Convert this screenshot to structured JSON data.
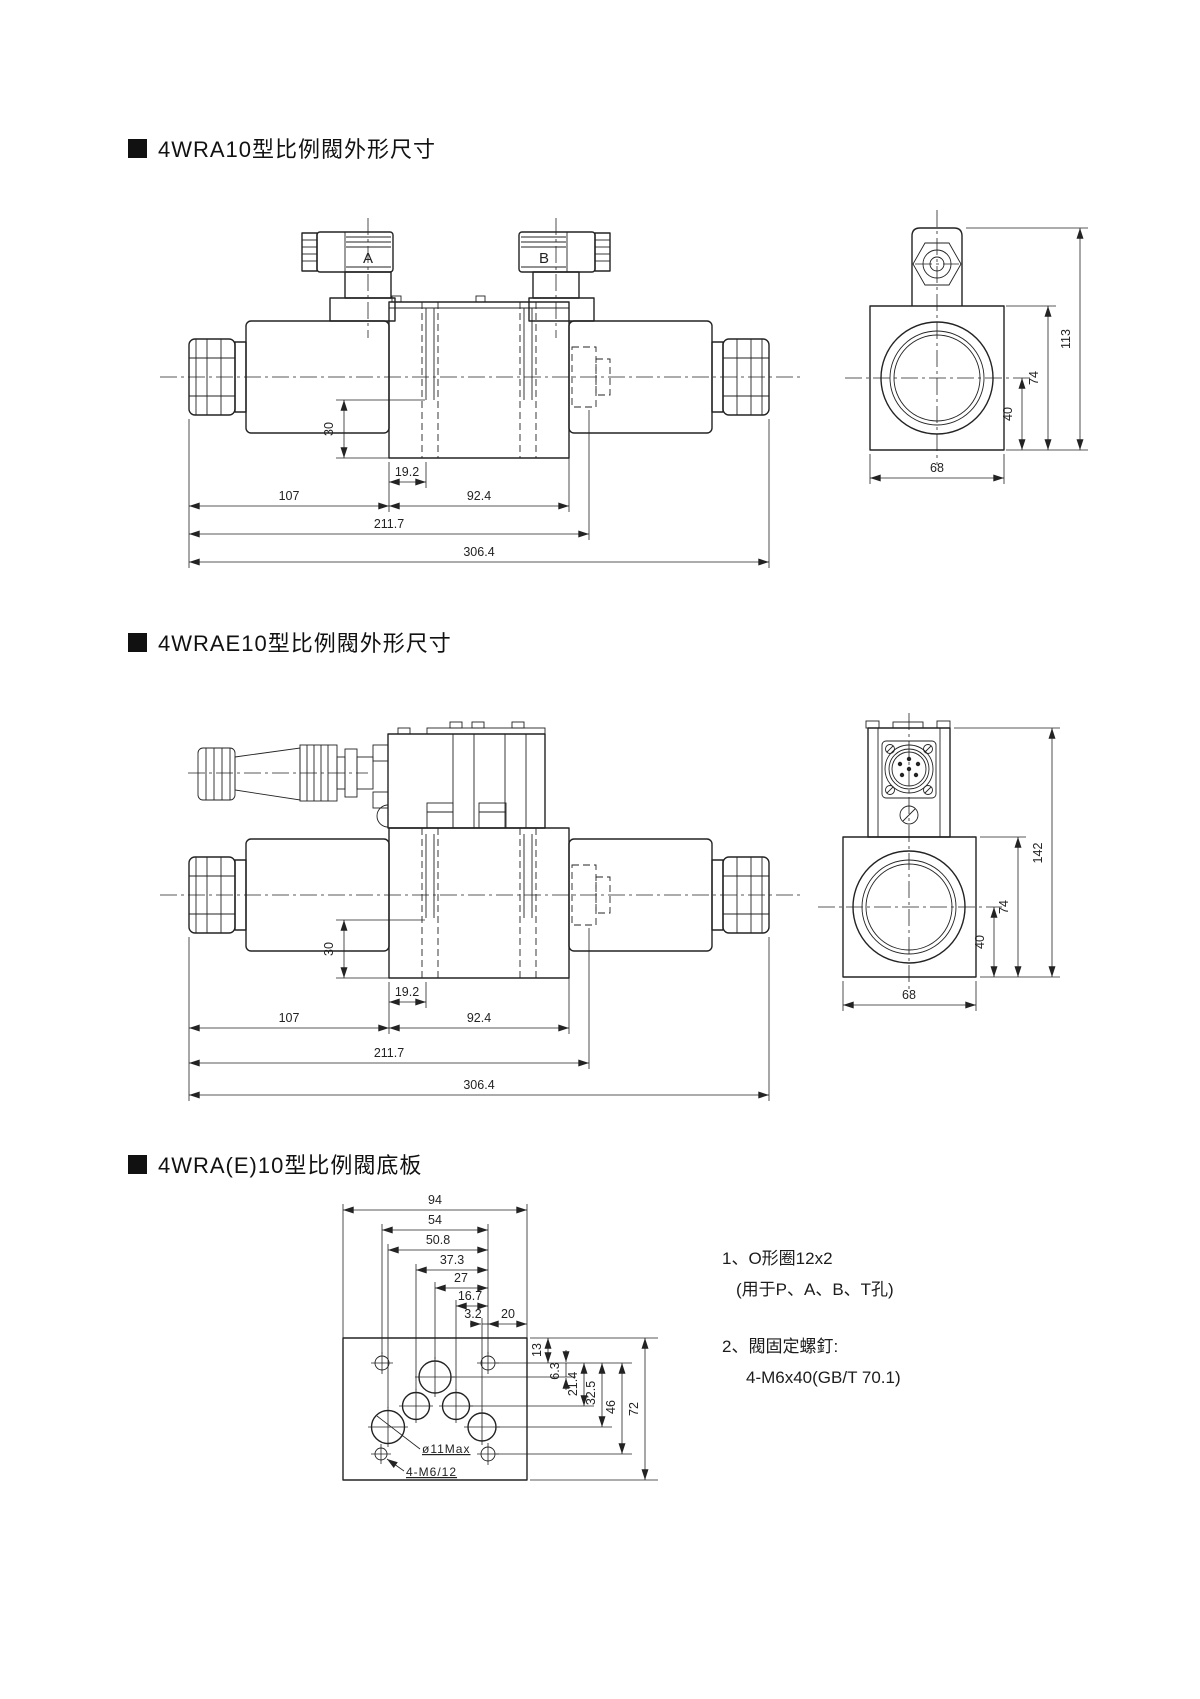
{
  "page": {
    "background": "#ffffff",
    "ink": "#232323"
  },
  "sections": {
    "s1": {
      "title": "4WRA10型比例閥外形尺寸"
    },
    "s2": {
      "title": "4WRAE10型比例閥外形尺寸"
    },
    "s3": {
      "title": "4WRA(E)10型比例閥底板"
    }
  },
  "d1": {
    "front": {
      "a": "A",
      "b": "B",
      "d30": "30",
      "d19_2": "19.2",
      "d107": "107",
      "d92_4": "92.4",
      "d211_7": "211.7",
      "d306_4": "306.4"
    },
    "side": {
      "d113": "113",
      "d74": "74",
      "d40": "40",
      "d68": "68"
    }
  },
  "d2": {
    "front": {
      "d30": "30",
      "d19_2": "19.2",
      "d107": "107",
      "d92_4": "92.4",
      "d211_7": "211.7",
      "d306_4": "306.4"
    },
    "side": {
      "d142": "142",
      "d74": "74",
      "d40": "40",
      "d68": "68"
    }
  },
  "d3": {
    "top": {
      "d94": "94",
      "d54": "54",
      "d50_8": "50.8",
      "d37_3": "37.3",
      "d27": "27",
      "d16_7": "16.7",
      "d3_2": "3.2",
      "d20": "20"
    },
    "right": {
      "d13": "13",
      "d6_3": "6.3",
      "d21_4": "21.4",
      "d32_5": "32.5",
      "d46": "46",
      "d72": "72"
    },
    "labels": {
      "hole": "ø11Max",
      "screw": "4-M6/12"
    }
  },
  "notes": {
    "n1a": "1、O形圈12x2",
    "n1b": "(用于P、A、B、T孔)",
    "n2a": "2、閥固定螺釘:",
    "n2b": "4-M6x40(GB/T 70.1)"
  }
}
